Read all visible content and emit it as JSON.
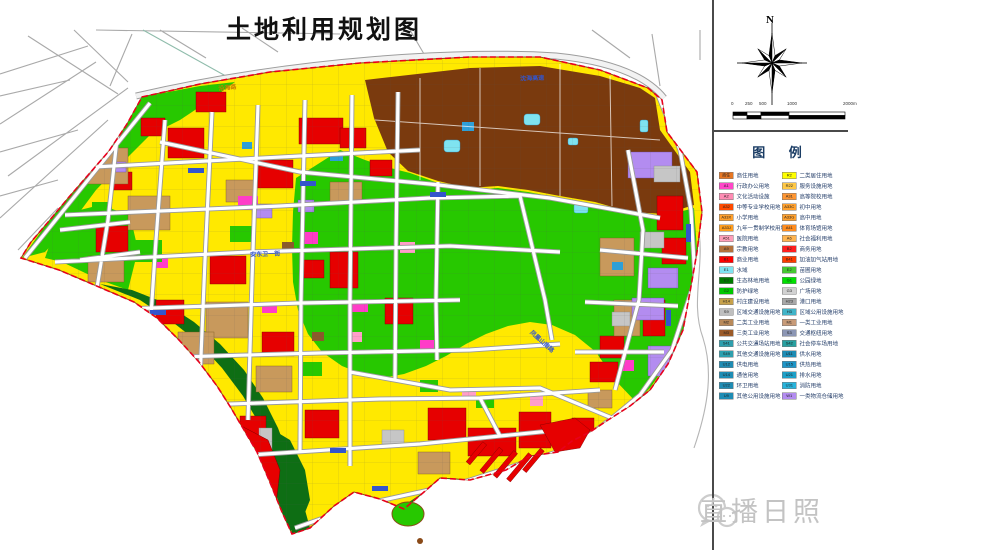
{
  "title": "土地利用规划图",
  "compass": {
    "north_label": "N"
  },
  "scalebar": {
    "labels": [
      "0",
      "250",
      "500",
      "1000",
      "2000m"
    ]
  },
  "legend": {
    "title": "图 例",
    "columns": [
      {
        "items": [
          {
            "code": "商住",
            "color": "#E87722",
            "label": "商住用地"
          },
          {
            "code": "A1",
            "color": "#FF47C8",
            "label": "行政办公用地"
          },
          {
            "code": "A2",
            "color": "#FF8CB4",
            "label": "文化活动设施"
          },
          {
            "code": "A32",
            "color": "#FF4B00",
            "label": "中等专业学校用地"
          },
          {
            "code": "A33X",
            "color": "#FFA02D",
            "label": "小学用地"
          },
          {
            "code": "A33J",
            "color": "#FF9D1E",
            "label": "九年一贯制学校用地"
          },
          {
            "code": "A51",
            "color": "#FF9EB9",
            "label": "医院用地"
          },
          {
            "code": "A9",
            "color": "#B4713C",
            "label": "宗教用地"
          },
          {
            "code": "B1",
            "color": "#FF0000",
            "label": "商业用地"
          },
          {
            "code": "E1",
            "color": "#7FE3F0",
            "label": "水域"
          },
          {
            "code": "E3",
            "color": "#007A00",
            "label": "生态林地用地"
          },
          {
            "code": "G2",
            "color": "#00C800",
            "label": "防护绿地"
          },
          {
            "code": "H14",
            "color": "#C8A24B",
            "label": "村庄建设用地"
          },
          {
            "code": "S9",
            "color": "#BFBFBF",
            "label": "区域交通设施用地"
          },
          {
            "code": "M2",
            "color": "#B98A5A",
            "label": "二类工业用地"
          },
          {
            "code": "M3",
            "color": "#9B5A28",
            "label": "三类工业用地"
          },
          {
            "code": "S41",
            "color": "#2E9FAE",
            "label": "公共交通场站用地"
          },
          {
            "code": "S49",
            "color": "#2E9FAE",
            "label": "其他交通设施用地"
          },
          {
            "code": "U12",
            "color": "#1E8CB4",
            "label": "供电用地"
          },
          {
            "code": "U14",
            "color": "#1E8CB4",
            "label": "通信用地"
          },
          {
            "code": "U22",
            "color": "#1E8CB4",
            "label": "环卫用地"
          },
          {
            "code": "U9",
            "color": "#1E8CB4",
            "label": "其他公用设施用地"
          }
        ]
      },
      {
        "items": [
          {
            "code": "R2",
            "color": "#FFFF00",
            "label": "二类居住用地"
          },
          {
            "code": "R22",
            "color": "#FFC846",
            "label": "服务设施用地"
          },
          {
            "code": "A31",
            "color": "#FF9632",
            "label": "高等院校用地"
          },
          {
            "code": "A33C",
            "color": "#FFA02D",
            "label": "初中用地"
          },
          {
            "code": "A33G",
            "color": "#FFA02D",
            "label": "高中用地"
          },
          {
            "code": "A41",
            "color": "#FF8C1E",
            "label": "体育场馆用地"
          },
          {
            "code": "A6",
            "color": "#FFB450",
            "label": "社会福利用地"
          },
          {
            "code": "B2",
            "color": "#FF1E1E",
            "label": "商务用地"
          },
          {
            "code": "B41",
            "color": "#FF3C00",
            "label": "加油加气站用地"
          },
          {
            "code": "E2",
            "color": "#46C832",
            "label": "苗圃用地"
          },
          {
            "code": "G1",
            "color": "#00E100",
            "label": "公园绿地"
          },
          {
            "code": "G3",
            "color": "#D2D2D2",
            "label": "广场用地"
          },
          {
            "code": "H23",
            "color": "#A8A8A8",
            "label": "港口用地"
          },
          {
            "code": "H3",
            "color": "#41B4C8",
            "label": "区域公用设施用地"
          },
          {
            "code": "M1",
            "color": "#C89B78",
            "label": "一类工业用地"
          },
          {
            "code": "S3",
            "color": "#8C96B4",
            "label": "交通枢纽用地"
          },
          {
            "code": "S42",
            "color": "#28A0A0",
            "label": "社会停车场用地"
          },
          {
            "code": "U11",
            "color": "#1E8CB4",
            "label": "供水用地"
          },
          {
            "code": "U15",
            "color": "#1E96C8",
            "label": "供热用地"
          },
          {
            "code": "U21",
            "color": "#1EA0C8",
            "label": "排水用地"
          },
          {
            "code": "U31",
            "color": "#28B4DC",
            "label": "消防用地"
          },
          {
            "code": "W1",
            "color": "#B38CF0",
            "label": "一类物流仓储用地"
          }
        ]
      }
    ]
  },
  "map": {
    "boundary_color": "#e8001c",
    "road_labels": [
      {
        "text": "沿海路",
        "x": 218,
        "y": 84,
        "angle": -6,
        "color": "#cc7a00"
      },
      {
        "text": "沈海高速",
        "x": 520,
        "y": 74,
        "angle": -2,
        "color": "#3355cc"
      },
      {
        "text": "安东卫一街",
        "x": 250,
        "y": 250,
        "angle": -2,
        "color": "#3355cc"
      },
      {
        "text": "凤凰山南路",
        "x": 534,
        "y": 328,
        "angle": 42,
        "color": "#3355cc"
      }
    ]
  },
  "watermark": {
    "text": "直播日照"
  }
}
